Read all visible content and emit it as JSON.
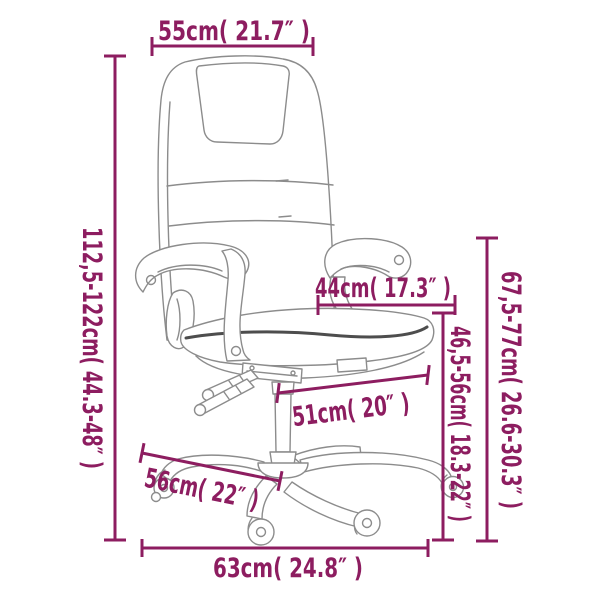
{
  "colors": {
    "dimension_accent": "#8d1d60",
    "artwork_line": "#8c8c8c",
    "artwork_dark_seam": "#4d4d4d",
    "background": "#ffffff"
  },
  "dimensions": {
    "top_width": {
      "label": "55cm( 21.7″ )"
    },
    "overall_height": {
      "label": "112,5-122cm( 44.3-48″ )"
    },
    "seat_depth_upper": {
      "label": "44cm( 17.3″ )"
    },
    "backrest_to_floor": {
      "label": "67,5-77cm( 26.6-30.3″ )"
    },
    "seat_to_floor": {
      "label": "46,5-56cm( 18.3-22″ )"
    },
    "seat_depth_lower": {
      "label": "51cm( 20″ )"
    },
    "base_depth": {
      "label": "56cm( 22″ )"
    },
    "base_width": {
      "label": "63cm( 24.8″ )"
    }
  }
}
